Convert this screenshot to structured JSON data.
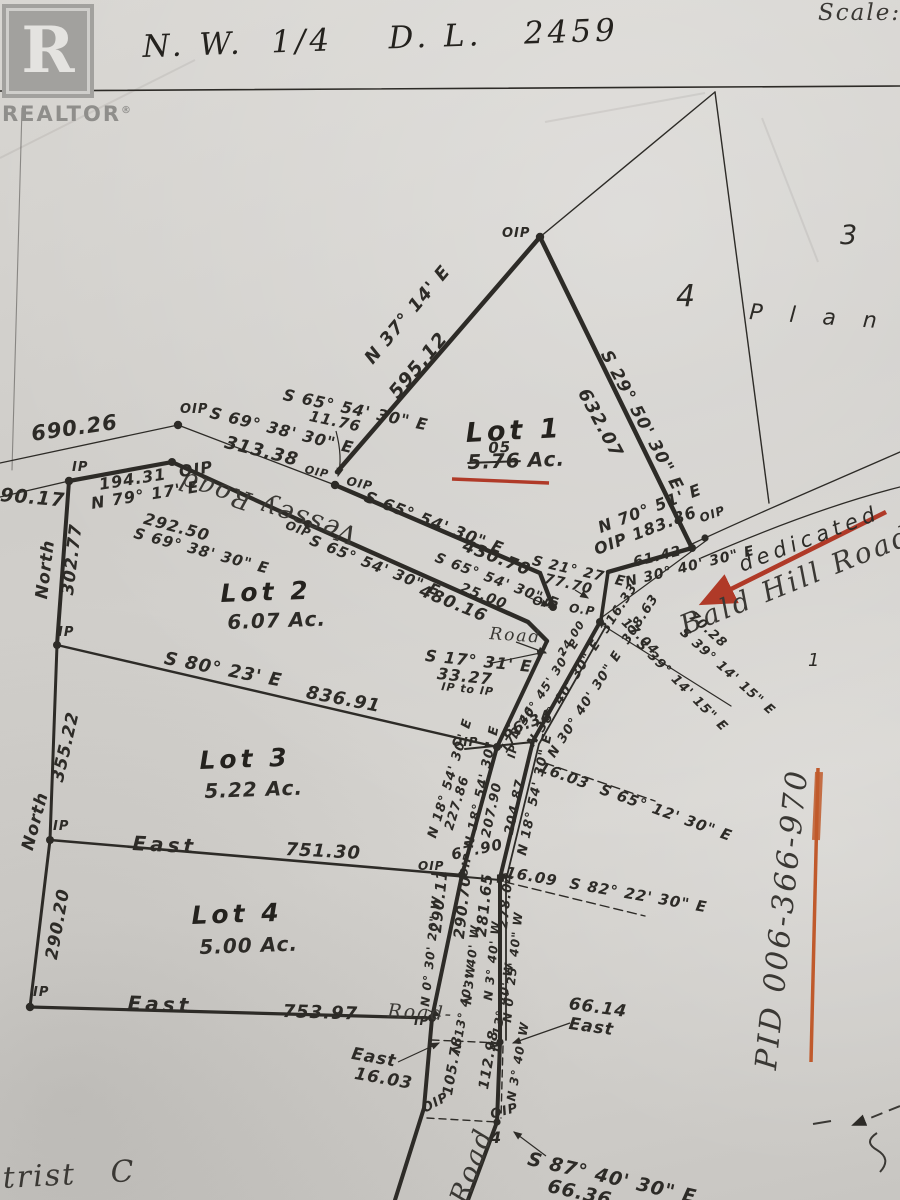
{
  "colors": {
    "paper": "#d4d2ce",
    "ink": "#2d2b27",
    "red_mark": "#b03a28",
    "orange_mark": "#c05a2c"
  },
  "branding": {
    "logo_letter": "R",
    "logo_word": "REALTOR",
    "reg": "®"
  },
  "header": {
    "title": "N. W.  1/4    D. L.   2459",
    "scale_label": "Scale:"
  },
  "plan": {
    "plan3": "3",
    "plan4": "4",
    "plan_word": "P l a n",
    "ref1": "1",
    "bottom4": "4",
    "dedicated": "dedicated   b",
    "bald_hill": "Bald Hill Road",
    "vessey": "Vessey Road",
    "road_near_junction": "Road",
    "road_lot4": "Road-",
    "road_bottom": "Road",
    "pid": "PID 006-366-970",
    "bottom_left_partial": "trist   C"
  },
  "lots": {
    "lot1": {
      "name": "Lot 1",
      "acreage_struck": "5.76",
      "acreage_correction": "05",
      "acreage_suffix": "Ac."
    },
    "lot2": {
      "name": "Lot 2",
      "acreage": "6.07 Ac."
    },
    "lot3": {
      "name": "Lot 3",
      "acreage": "5.22 Ac."
    },
    "lot4": {
      "name": "Lot 4",
      "acreage": "5.00 Ac."
    }
  },
  "markers": {
    "oip": "OIP",
    "ip": "IP",
    "op": "O.P"
  },
  "bearings": {
    "d690_26": "690.26",
    "d90_17": "90.17",
    "d194": "194.31  OIP",
    "n79": "N 79° 17' E",
    "d292": "292.50",
    "s69b": "S 69° 38' 30\" E",
    "s69a": "S 69° 38' 30\" E",
    "d313": "313.38",
    "s65a": "S 65° 54' 30\" E",
    "d11": "11.76",
    "n37": "N 37° 14' E",
    "d595": "595.12",
    "s29": "S 29° 50' 30\" E",
    "d632": "632.07",
    "s65b": "S 65° 54' 30\" E",
    "d430": "430.70",
    "s65c": "S 65° 54' 30\" E",
    "d25": "25.00",
    "s65d": "S 65° 54' 30\" E",
    "d480": "480.16",
    "s21": "S 21° 27' E",
    "d77": "77.70",
    "n70": "N 70° 51' E",
    "d183": "OIP 183.86",
    "d61": "61.42",
    "n30a": "N 30° 40' 30\" E",
    "d70_28": "70.28",
    "s39a": "S 39° 14' 15\" E",
    "d17_04": "17.04",
    "s39b": "S 39° 14' 15\" E",
    "s17": "S 17° 31' E",
    "d33": "33.27",
    "iptoip": "IP to IP",
    "d173": "173.46",
    "n3045": "N 30° 45' 30\" E",
    "d24": "24.00",
    "n30b": "N 30° 40' 30\" E  316.33",
    "n30c": "N 30° 40' 30\" E  308.63",
    "d66_34": "66.34",
    "n18a": "N 18° 54' 30\" E",
    "d227": "227.86",
    "n18b": "N 18° 54' 30\" E",
    "d207": "207.90",
    "d204": "204.87",
    "n18c": "N 18° 54' 30\" E",
    "t16_03a": "16.03  S 65° 12' 30\" E",
    "d67_90": "67.90",
    "t16_09": "16.09  S 82° 22' 30\" E",
    "d290_11": "290.11",
    "n0_30": "N 0° 30' 20\" W",
    "d290_70": "290.70",
    "n3a": "N 3° 40' W",
    "d281": "281.65",
    "n3b": "N 3° 40' W",
    "d278": "278.04",
    "n0_25": "N 0° 25' 40\" W",
    "east16": "East",
    "d16_03": "16.03",
    "d105": "105.78",
    "n13a": "N 13° 40' W",
    "d112": "112.98",
    "n13b": "N 13° 40' W",
    "n3c": "N 3° 40' W",
    "d66_14": "66.14",
    "east3": "East",
    "s87": "S 87° 40' 30\" E",
    "d66_36": "66.36",
    "s80": "S 80° 23' E",
    "d836": "836.91",
    "east1": "East",
    "d751": "751.30",
    "east2": "East",
    "d753": "753.97",
    "north1": "North",
    "d302": "302.77",
    "north2": "North",
    "d355": "355.22",
    "d290_20": "290.20"
  }
}
